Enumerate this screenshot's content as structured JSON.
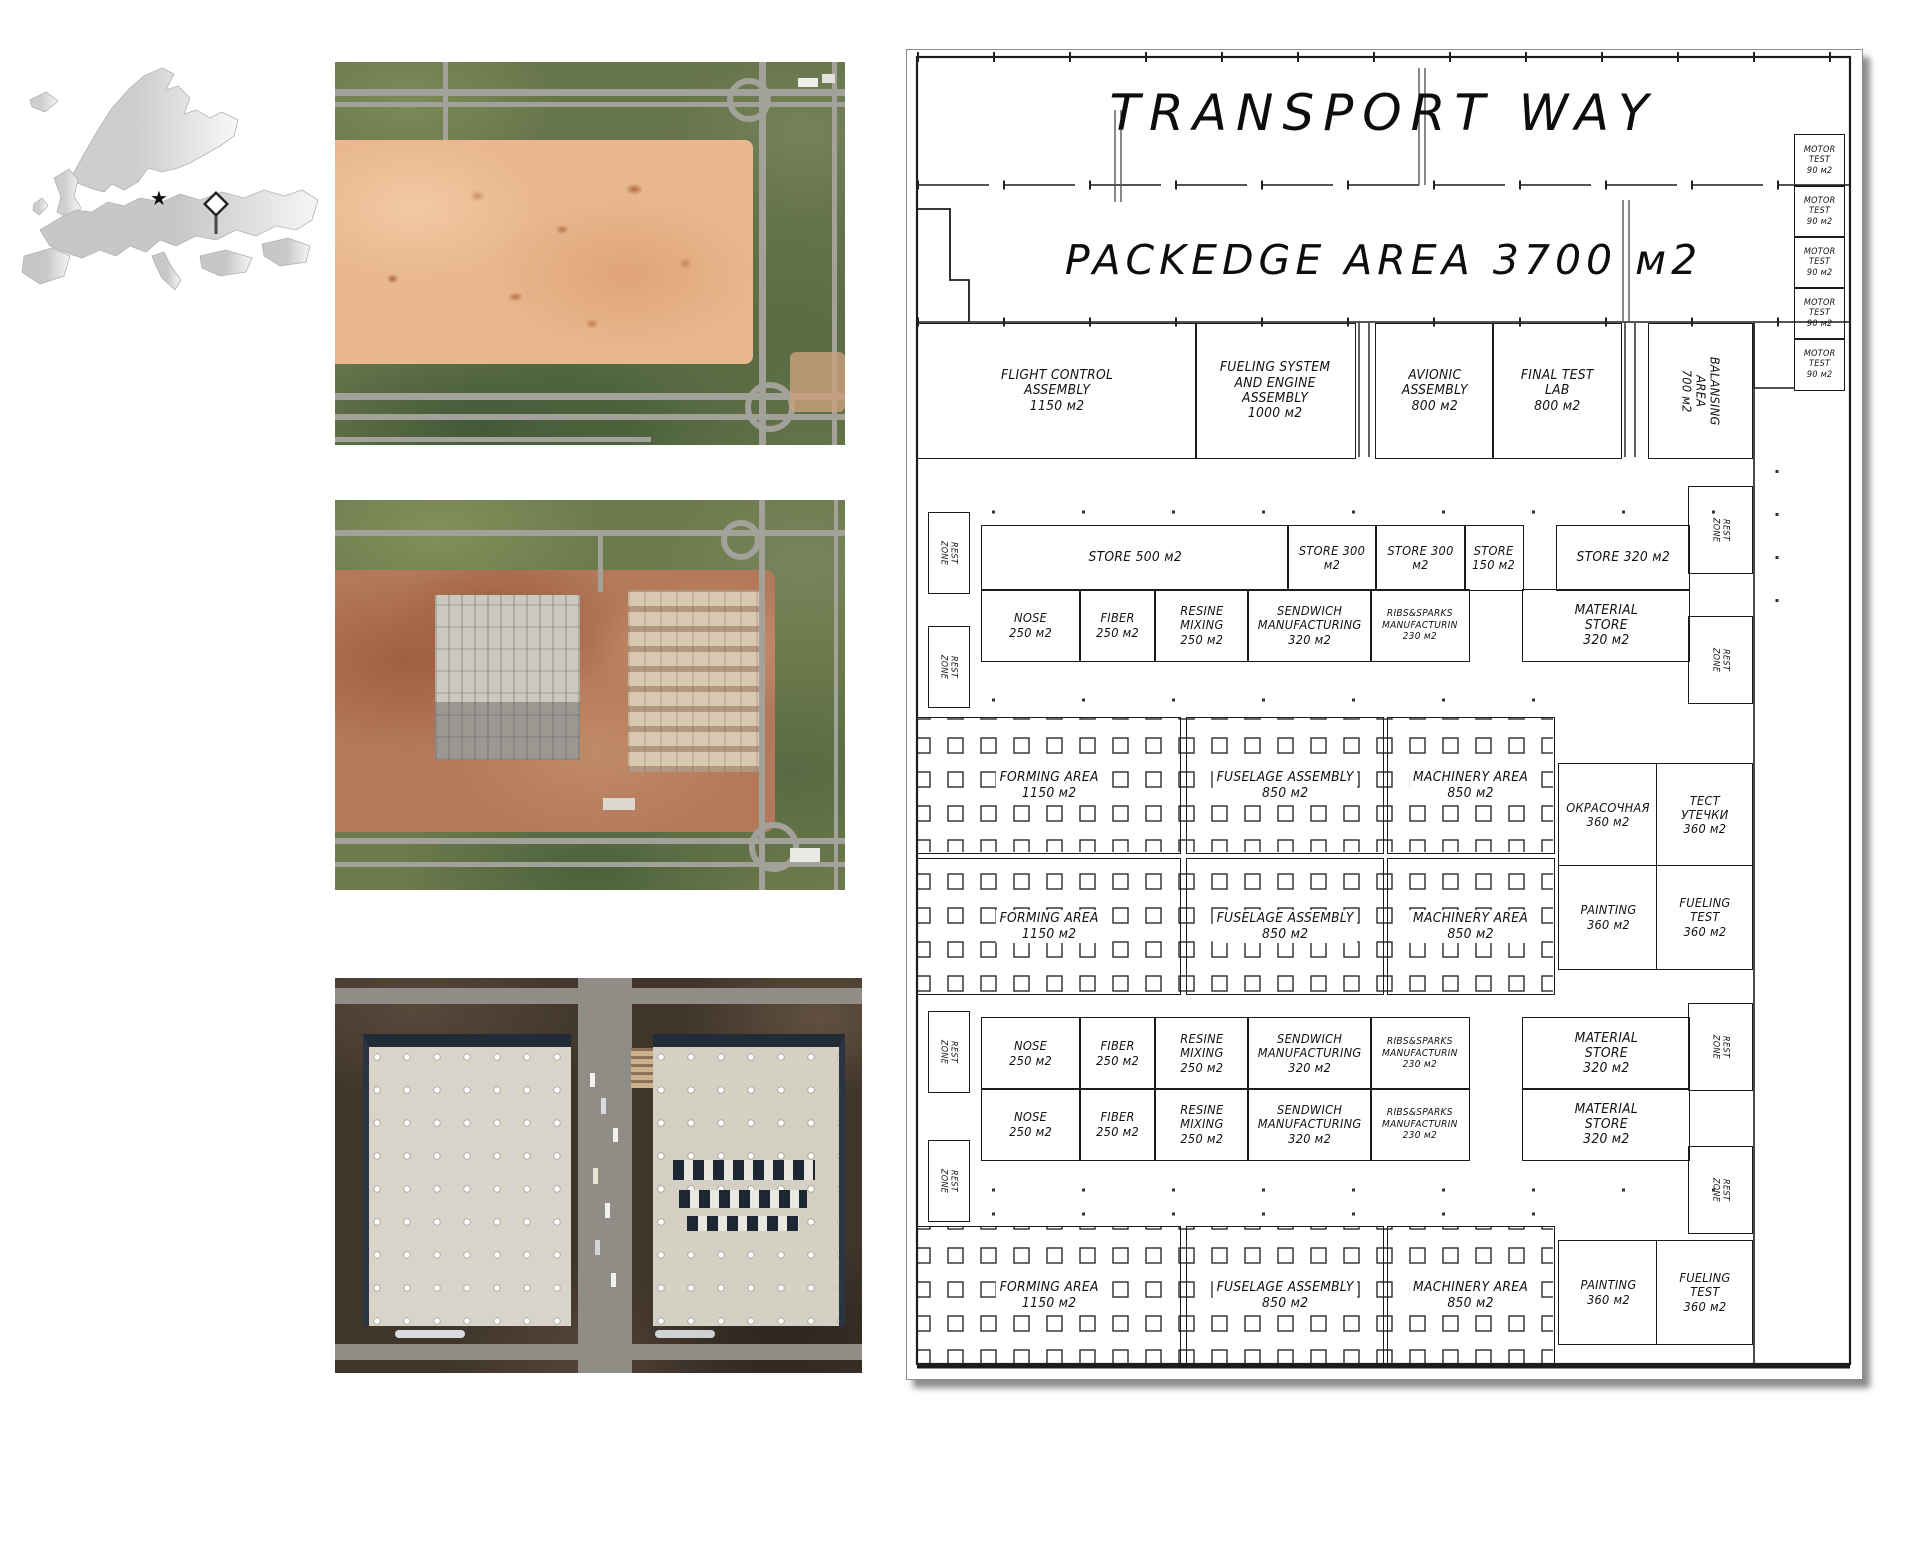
{
  "colors": {
    "line": "#1c1c1c",
    "paper": "#ffffff",
    "soil_tan": "#e9b88e",
    "soil_red": "#b4795b",
    "roof_gray": "#d8d4ca"
  },
  "map": {
    "star": "★"
  },
  "plan": {
    "street_title": "TRANSPORT WAY",
    "packedge_label": "PACKEDGE AREA 3700 м2",
    "rooms": {
      "motor_test": "MOTOR\nTEST\n90 м2",
      "flight_control": "FLIGHT CONTROL\nASSEMBLY\n1150 м2",
      "fueling_system": "FUELING SYSTEM\nAND ENGINE\nASSEMBLY\n1000 м2",
      "avionic": "AVIONIC\nASSEMBLY\n800 м2",
      "final_test_lab": "FINAL TEST\nLAB\n800 м2",
      "balansing": "BALANSING\nAREA\n700 м2",
      "rest_zone": "REST\nZONE",
      "store_500": "STORE 500 м2",
      "store_300": "STORE 300 м2",
      "store_150": "STORE\n150 м2",
      "store_320": "STORE 320 м2",
      "material_store": "MATERIAL\nSTORE\n320 м2",
      "nose": "NOSE\n250 м2",
      "fiber": "FIBER\n250 м2",
      "resine_mixing": "RESINE\nMIXING\n250 м2",
      "sendwich": "SENDWICH\nMANUFACTURING\n320 м2",
      "ribs_sparks": "RIBS&SPARKS\nMANUFACTURIN\n230 м2",
      "forming": "FORMING AREA\n1150 м2",
      "fuselage": "FUSELAGE ASSEMBLY\n850 м2",
      "machinery": "MACHINERY AREA\n850 м2",
      "okrasochnaya": "ОКРАСОЧНАЯ\n360 м2",
      "test_utechki": "ТЕСТ\nУТЕЧКИ\n360 м2",
      "painting": "PAINTING\n360 м2",
      "fueling_test": "FUELING\nTEST\n360 м2"
    }
  }
}
